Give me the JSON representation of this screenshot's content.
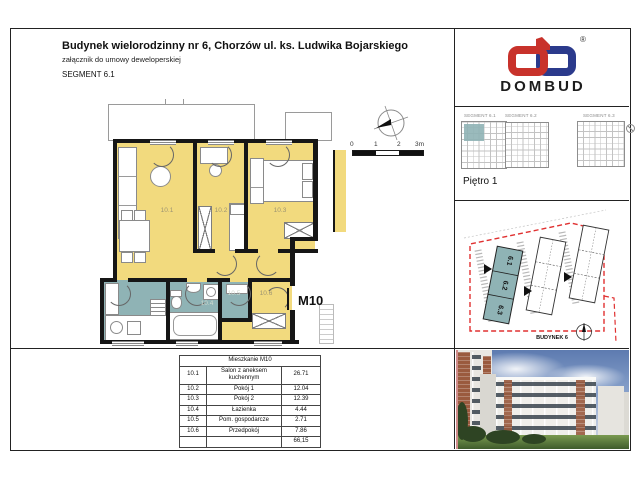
{
  "header": {
    "title": "Budynek wielorodzinny nr 6, Chorzów ul. ks. Ludwika Bojarskiego",
    "subtitle": "załącznik do umowy deweloperskiej",
    "segment": "SEGMENT 6.1"
  },
  "logo": {
    "brand": "DOMBUD",
    "registered": "®",
    "red": "#C8322B",
    "blue": "#2B3A8C"
  },
  "plan": {
    "apartment_label": "M10",
    "rooms": [
      {
        "no": "10.1",
        "name": "Salon z aneksem kuchennym",
        "area": "26.71"
      },
      {
        "no": "10.2",
        "name": "Pokój 1",
        "area": "12.04"
      },
      {
        "no": "10.3",
        "name": "Pokój 2",
        "area": "12.39"
      },
      {
        "no": "10.4",
        "name": "Łazienka",
        "area": "4.44"
      },
      {
        "no": "10.5",
        "name": "Pom. gospodarcze",
        "area": "2.71"
      },
      {
        "no": "10.6",
        "name": "Przedpokój",
        "area": "7.86"
      }
    ],
    "colors": {
      "room_fill": "#F2DA7E",
      "wet_room_fill": "#8FB3B5"
    },
    "scalebar": {
      "labels": [
        "0",
        "1",
        "2",
        "3m"
      ]
    }
  },
  "overview": {
    "segments": [
      "SEGMENT 6.1",
      "SEGMENT 6.2",
      "SEGMENT 6.3"
    ],
    "floor": "Piętro 1"
  },
  "siteplan": {
    "units": [
      "6.1",
      "6.2",
      "6.3"
    ],
    "building_caption": "BUDYNEK 6",
    "boundary_color": "#E03030"
  },
  "table": {
    "header": "Mieszkanie M10",
    "total": "66,15"
  }
}
